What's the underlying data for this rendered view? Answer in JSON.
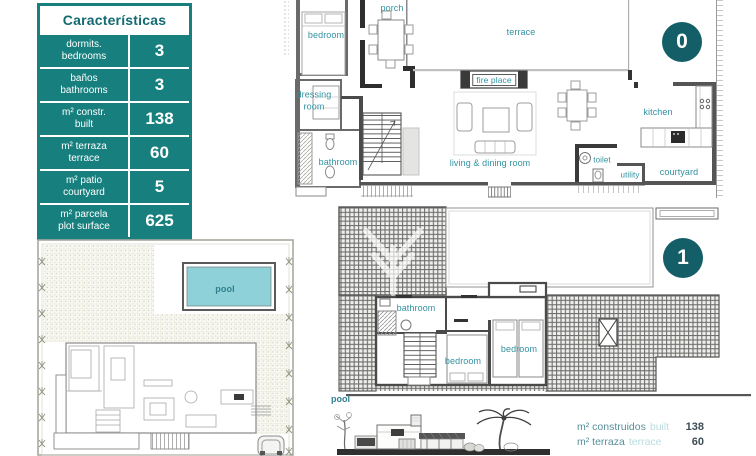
{
  "table": {
    "title": "Características",
    "rows": [
      {
        "es": "dormits.",
        "en": "bedrooms",
        "value": "3"
      },
      {
        "es": "baños",
        "en": "bathrooms",
        "value": "3"
      },
      {
        "es": "m² constr.",
        "en": "built",
        "value": "138"
      },
      {
        "es": "m² terraza",
        "en": "terrace",
        "value": "60"
      },
      {
        "es": "m² patio",
        "en": "courtyard",
        "value": "5"
      },
      {
        "es": "m² parcela",
        "en": "plot surface",
        "value": "625"
      }
    ]
  },
  "plan0": {
    "badge": "0",
    "labels": {
      "bedroom": "bedroom",
      "porch": "porch",
      "terrace": "terrace",
      "fireplace": "fire place",
      "dressing_room": "dressing room",
      "bathroom": "bathroom",
      "living": "living & dining room",
      "kitchen": "kitchen",
      "toilet": "toilet",
      "utility": "utility",
      "courtyard": "courtyard"
    }
  },
  "plan1": {
    "badge": "1",
    "labels": {
      "bathroom": "bathroom",
      "bedroom_left": "bedroom",
      "bedroom_right": "bedroom",
      "pool": "pool"
    }
  },
  "siteplan": {
    "pool": "pool"
  },
  "summary": {
    "rows": [
      {
        "label": "m² construidos",
        "label_en": "built",
        "value": "138"
      },
      {
        "label": "m² terraza",
        "label_en": "terrace",
        "value": "60"
      }
    ]
  },
  "colors": {
    "accent_teal": "#17807E",
    "badge_teal": "#135E67",
    "room_label_teal": "#3191A1",
    "pool_fill": "#8FD1D8"
  }
}
